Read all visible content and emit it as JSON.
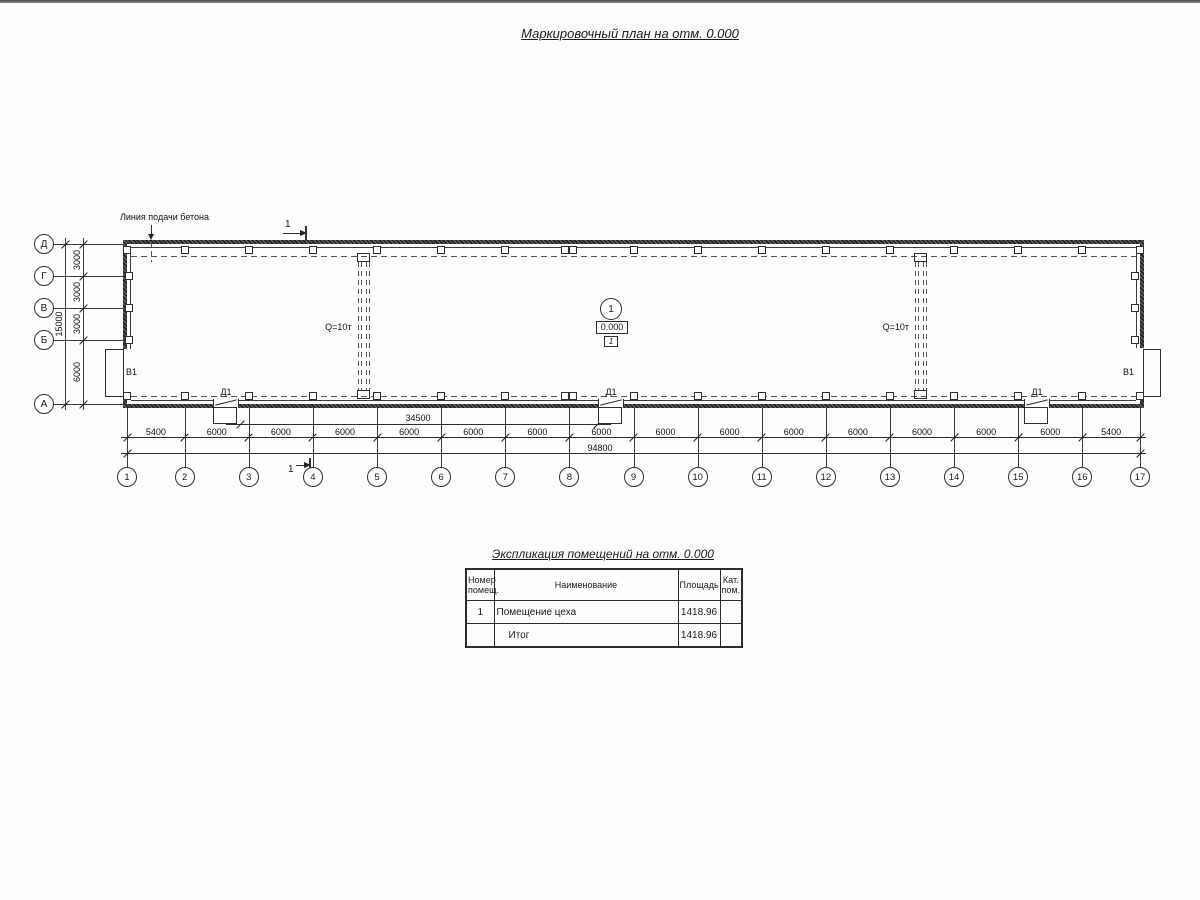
{
  "page": {
    "title": "Маркировочный план на отм. 0.000"
  },
  "plan": {
    "concrete_line_label": "Линия подачи бетона",
    "section_label": "1",
    "room_marker": {
      "number": "1",
      "elevation": "0.000",
      "category": "1"
    },
    "cranes": [
      {
        "label": "Q=10т"
      },
      {
        "label": "Q=10т"
      }
    ],
    "doors": [
      {
        "label": "Д1"
      },
      {
        "label": "Д1"
      },
      {
        "label": "Д1"
      }
    ],
    "gates": [
      {
        "label": "В1"
      },
      {
        "label": "В1"
      }
    ],
    "axes_bottom": [
      "1",
      "2",
      "3",
      "4",
      "5",
      "6",
      "7",
      "8",
      "9",
      "10",
      "11",
      "12",
      "13",
      "14",
      "15",
      "16",
      "17"
    ],
    "axes_left": [
      "Д",
      "Г",
      "В",
      "Б",
      "А"
    ],
    "dims_bottom": [
      "5400",
      "6000",
      "6000",
      "6000",
      "6000",
      "6000",
      "6000",
      "6000",
      "6000",
      "6000",
      "6000",
      "6000",
      "6000",
      "6000",
      "6000",
      "5400"
    ],
    "dims_left": [
      "3000",
      "3000",
      "3000",
      "6000"
    ],
    "dim_left_total": "15000",
    "dim_doors": "34500",
    "dim_total": "94800"
  },
  "table": {
    "title": "Экспликация помещений на отм. 0.000",
    "headers": [
      "Номер\nпомещ.",
      "Наименование",
      "Площадь",
      "Кат.\nпом."
    ],
    "rows": [
      {
        "number": "1",
        "name": "Помещение цеха",
        "area": "1418.96",
        "category": ""
      },
      {
        "number": "",
        "name": "Итог",
        "area": "1418.96",
        "category": ""
      }
    ]
  }
}
